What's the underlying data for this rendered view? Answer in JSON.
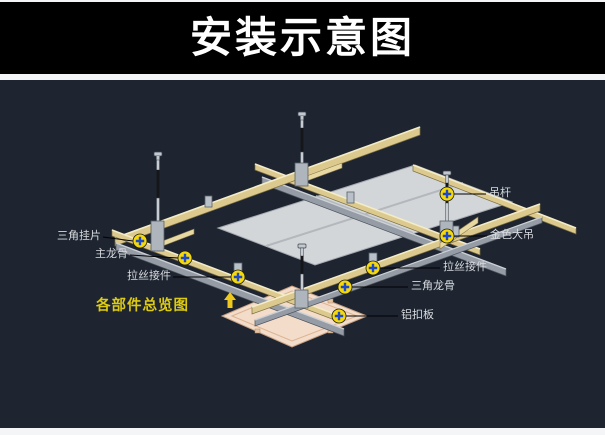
{
  "header": {
    "title": "安装示意图",
    "bg": "#000000",
    "text_color": "#ffffff"
  },
  "diagram": {
    "bg": "#1e2531",
    "caption": "各部件总览图",
    "caption_color": "#ddca12",
    "label_color": "#d8dbdf",
    "leader_color": "#000000",
    "marker_fill": "#f6d90a",
    "marker_cross": "#1d49c8",
    "keel_gold_color": "#dcc98e",
    "keel_gray_color": "#959ca5",
    "tile_color": "#d3d6d9",
    "panel_color": "#f3dcc9",
    "parts": [
      {
        "text": "三角挂片",
        "side": "left",
        "lx": 101,
        "ly": 237,
        "mx": 140,
        "my": 241
      },
      {
        "text": "主龙骨",
        "side": "left",
        "lx": 128,
        "ly": 255,
        "mx": 185,
        "my": 258
      },
      {
        "text": "拉丝接件",
        "side": "left",
        "lx": 171,
        "ly": 277,
        "mx": 238,
        "my": 277
      },
      {
        "text": "吊杆",
        "side": "right",
        "lx": 489,
        "ly": 194,
        "mx": 447,
        "my": 194
      },
      {
        "text": "金色大吊",
        "side": "right",
        "lx": 490,
        "ly": 236,
        "mx": 447,
        "my": 236
      },
      {
        "text": "拉丝接件",
        "side": "right",
        "lx": 443,
        "ly": 268,
        "mx": 373,
        "my": 268
      },
      {
        "text": "三角龙骨",
        "side": "right",
        "lx": 411,
        "ly": 287,
        "mx": 345,
        "my": 287
      },
      {
        "text": "铝扣板",
        "side": "right",
        "lx": 401,
        "ly": 316,
        "mx": 339,
        "my": 316
      }
    ]
  }
}
